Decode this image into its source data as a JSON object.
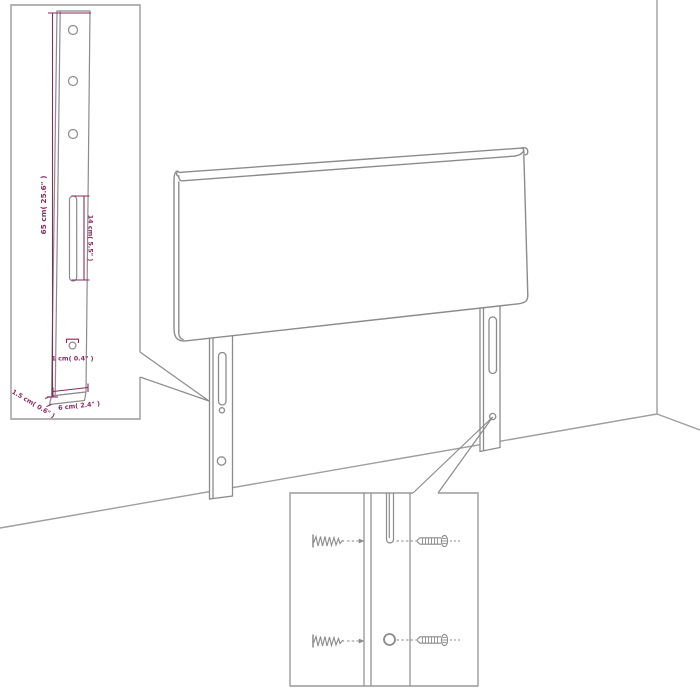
{
  "diagram": {
    "type": "product-dimension-diagram",
    "subject": "upholstered headboard with two mounting legs shown against a room corner",
    "background_color": "#ffffff",
    "line_color": "#8b8b8b",
    "wall_line_color": "#9e9e9e",
    "dimension_color": "#872a60",
    "insets": [
      {
        "name": "leg-dimension-detail",
        "position": "top-left"
      },
      {
        "name": "screw-mounting-detail",
        "position": "bottom-right"
      }
    ]
  },
  "leg_inset": {
    "dim_height": "65 cm( 25.6\" )",
    "dim_slot": "14 cm( 5.5\" )",
    "dim_hole": "1 cm( 0.4\" )",
    "dim_thickness": "1.5 cm( 0.6\" )",
    "dim_width": "6 cm( 2.4\" )"
  },
  "screw_inset": {
    "icons": [
      "wood-screw-icon",
      "machine-screw-icon",
      "slot-hole",
      "round-hole"
    ]
  }
}
